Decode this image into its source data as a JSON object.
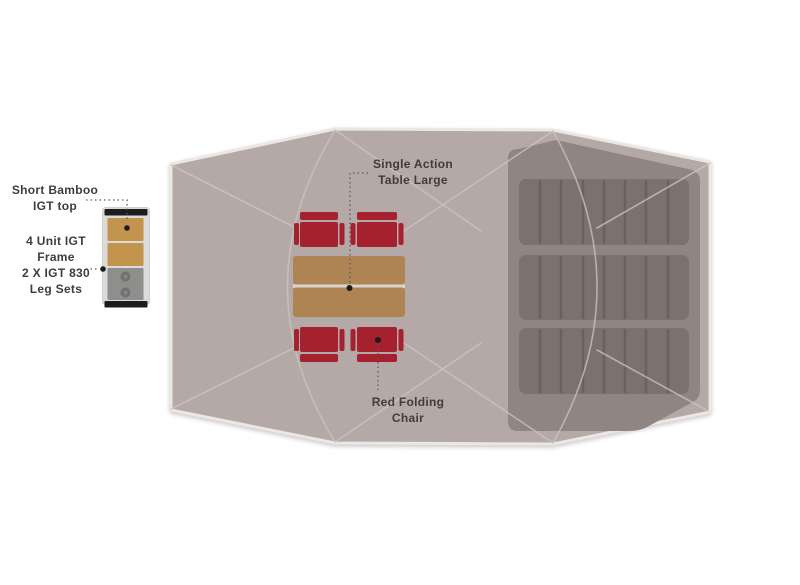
{
  "annotations": {
    "table_label": "Single Action\nTable Large",
    "chair_label": "Red Folding\nChair"
  },
  "legend": {
    "bamboo_top_label": "Short Bamboo\nIGT top",
    "frame_label": "4 Unit IGT\nFrame\n2 X IGT 830\nLeg Sets"
  },
  "colors": {
    "tent": "#b4a9a6",
    "tent_outline": "#eae7e5",
    "seam": "#cdc4c1",
    "inner_room": "#8f8583",
    "mat": "#7b7270",
    "mat_line": "#6a615f",
    "chair_red": "#a52130",
    "table_tan": "#ae8455",
    "table_gap": "#d8d3cf",
    "legend_frame": "#dbdbd9",
    "legend_bar": "#1d1d1d",
    "legend_bamboo": "#c2944e",
    "legend_gray": "#8e8e8c",
    "legend_burner": "#717170",
    "legend_burner_inner": "#868684",
    "text": "#413c3a",
    "leader": "#5a5a5a",
    "dot": "#1b1b1b"
  }
}
